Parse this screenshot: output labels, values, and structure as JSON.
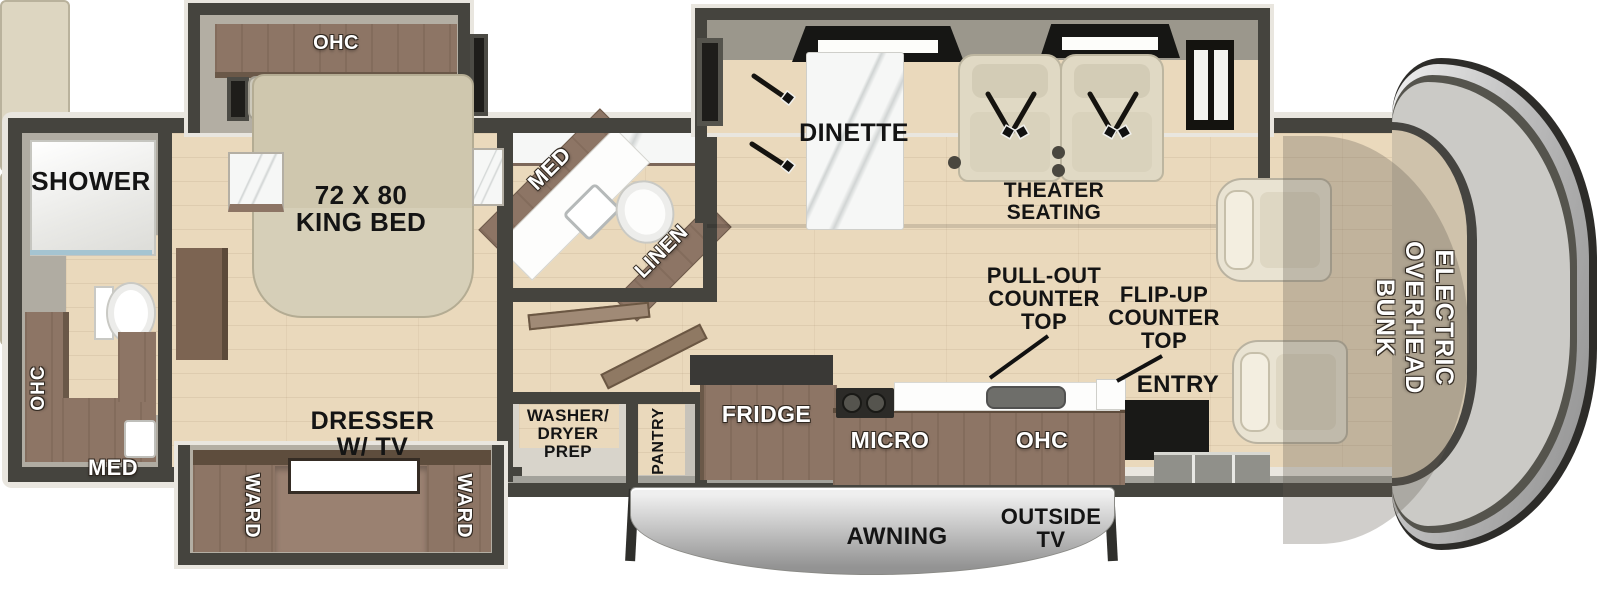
{
  "colors": {
    "wall": "#45443e",
    "trim": "#e9e6df",
    "floor": "#ead9bc",
    "slidefloor": "#b3aea3",
    "bath": "#b0aca2",
    "cabinet": "#8d7565",
    "cabinet_dark": "#5e4d3d",
    "seat": "#ddd6c1",
    "marble": "#f6f7f6",
    "counter": "#fdfdfc",
    "window": "#1e1d1a",
    "bunk": "#cbcac6",
    "awning_light": "#efefef",
    "awning_dark": "#939393"
  },
  "floorplan": {
    "rear_bath": {
      "shower_label": "SHOWER",
      "ohc_label": "OHC",
      "med_label": "MED"
    },
    "bedroom": {
      "ohc_label": "OHC",
      "bed_label": "72 X 80\nKING BED",
      "dresser_label": "DRESSER\nW/ TV",
      "ward_left_label": "WARD",
      "ward_right_label": "WARD"
    },
    "mid_bath": {
      "med_label": "MED",
      "linen_label": "LINEN"
    },
    "utility": {
      "washer_dryer_label": "WASHER/\nDRYER\nPREP",
      "pantry_label": "PANTRY"
    },
    "kitchen": {
      "fridge_label": "FRIDGE",
      "micro_label": "MICRO",
      "ohc_label": "OHC",
      "pull_out_label": "PULL-OUT\nCOUNTER\nTOP",
      "flip_up_label": "FLIP-UP\nCOUNTER\nTOP",
      "entry_label": "ENTRY"
    },
    "living": {
      "dinette_label": "DINETTE",
      "theater_label": "THEATER\nSEATING"
    },
    "cab": {
      "bunk_label": "ELECTRIC\nOVERHEAD\nBUNK"
    },
    "exterior": {
      "awning_label": "AWNING",
      "outside_tv_label": "OUTSIDE\nTV"
    }
  }
}
